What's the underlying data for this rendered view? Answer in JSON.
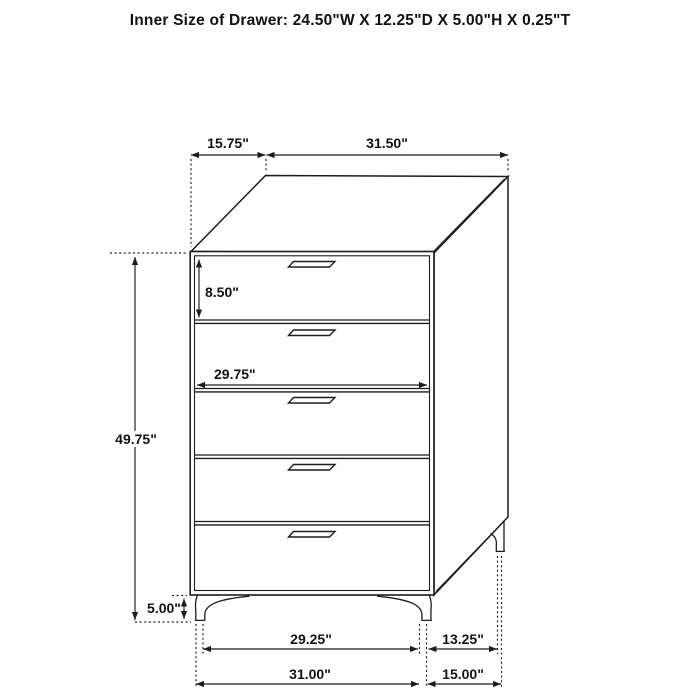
{
  "title": "Inner Size of Drawer: 24.50\"W X 12.25\"D X 5.00\"H X 0.25\"T",
  "figure": {
    "kind": "chest-of-drawers dimension diagram",
    "drawer_count": 5
  },
  "dimensions": {
    "top_depth": "15.75\"",
    "top_width": "31.50\"",
    "top_drawer_height": "8.50\"",
    "drawer_inner_width": "29.75\"",
    "overall_height": "49.75\"",
    "leg_height": "5.00\"",
    "front_feet_span": "29.25\"",
    "side_feet_span": "13.25\"",
    "overall_width": "31.00\"",
    "overall_depth": "15.00\""
  },
  "colors": {
    "line": "#1c1c1c",
    "text": "#111111",
    "background": "#ffffff"
  }
}
